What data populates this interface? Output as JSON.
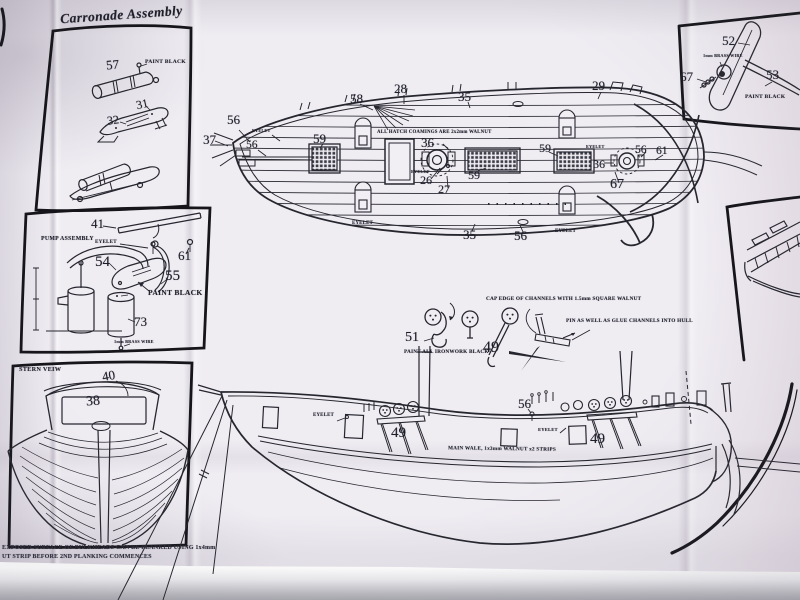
{
  "carronade": {
    "title": "Carronade Assembly",
    "n57": "57",
    "n31": "31",
    "n32": "32",
    "paint_black": "PAINT BLACK"
  },
  "rudder_detail": {
    "n52": "52",
    "n53": "53",
    "n67": "67",
    "brass_wire": "1mm BRASS WIRE",
    "paint_black": "PAINT BLACK"
  },
  "pump": {
    "title": "PUMP ASSEMBLY",
    "eyelet": "EYELET",
    "n41": "41",
    "n54": "54",
    "n61": "61",
    "n55": "55",
    "n73": "73",
    "paint_black": "PAINT BLACK",
    "brass_wire": "1mm BRASS WIRE"
  },
  "stern_view": {
    "title": "STERN VEIW",
    "n40": "40",
    "n38": "38"
  },
  "deck_plan": {
    "coaming_note": "ALL HATCH COAMINGS ARE 2x2mm WALNUT",
    "eyelet": "EYELET",
    "n56": "56",
    "n37": "37",
    "n58": "58",
    "n28": "28",
    "n35": "35",
    "n29": "29",
    "n59": "59",
    "n36": "36",
    "n26": "26",
    "n27": "27",
    "n67": "67",
    "n61": "61"
  },
  "rigging_notes": {
    "cap_note": "CAP EDGE OF CHANNELS WITH 1.5mm SQUARE WALNUT",
    "pin_note": "PIN AS WELL AS GLUE CHANNELS INTO HULL",
    "iron_note": "PAINT ALL IRONWORK BLACK",
    "n51": "51",
    "n49": "49"
  },
  "profile": {
    "eyelet": "EYELET",
    "n49": "49",
    "n56": "56",
    "main_wale": "MAIN WALE, 1x3mm WALNUT x2 STRIPS"
  },
  "footer": {
    "line1": "EXPOSED SURFACE OF BULKHEADS CAN BE PLANKED USING 1x4mm",
    "line2": "UT STRIP BEFORE 2ND PLANKING COMMENCES"
  },
  "colors": {
    "paper": "#efecf2",
    "ink": "#26262f",
    "panel_border": "#15151a"
  }
}
